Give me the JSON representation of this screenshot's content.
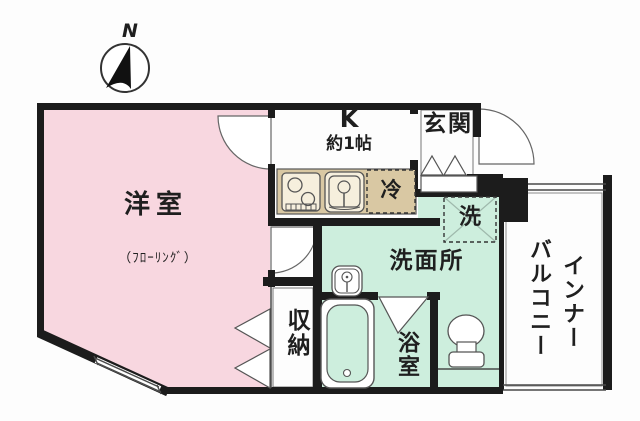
{
  "compass": {
    "north": "N"
  },
  "labels": {
    "living_room": "洋室",
    "living_room_note": "（ﾌﾛｰﾘﾝｸﾞ）",
    "kitchen": "K",
    "kitchen_size": "約1帖",
    "entrance": "玄関",
    "refrigerator": "冷",
    "washing_machine": "洗",
    "washroom": "洗面所",
    "storage": "収納",
    "bathroom": "浴室",
    "balcony_col_right": "インナー",
    "balcony_col_left": "バルコニー"
  },
  "colors": {
    "living_room_fill": "#f8d7e0",
    "wet_area_fill": "#cdeedd",
    "kitchen_counter_fill": "#d9c8a3",
    "wall": "#1c1c1c",
    "background": "#fdfdfd",
    "thin_line": "#4a4a4a"
  }
}
